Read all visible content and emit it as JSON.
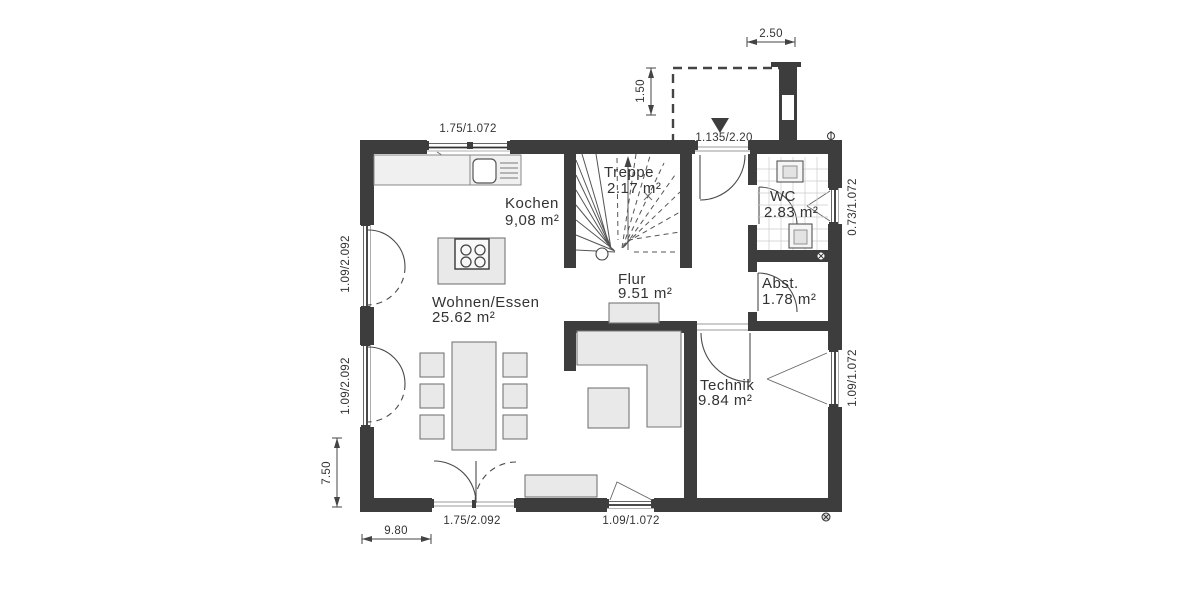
{
  "rooms": {
    "kochen": {
      "label": "Kochen",
      "area": "9,08 m²"
    },
    "treppe": {
      "label": "Treppe",
      "area": "2.17 m²"
    },
    "wc": {
      "label": "WC",
      "area": "2.83 m²"
    },
    "abstellraum": {
      "label": "Abst.",
      "area": "1.78 m²"
    },
    "flur": {
      "label": "Flur",
      "area": "9.51 m²"
    },
    "wohnen_essen": {
      "label": "Wohnen/Essen",
      "area": "25.62 m²"
    },
    "technik": {
      "label": "Technik",
      "area": "9.84 m²"
    }
  },
  "dimensions": {
    "kitchen_window": "1.75/1.072",
    "entrance_door": "1.135/2.20",
    "porch_width": "2.50",
    "porch_depth": "1.50",
    "wc_window": "0.73/1.072",
    "technik_window": "1.09/1.072",
    "left_window_upper": "1.09/2.092",
    "left_window_lower": "1.09/2.092",
    "terrace_door": "1.75/2.092",
    "bottom_window": "1.09/1.072",
    "overall_width": "9.80",
    "overall_depth": "7.50"
  },
  "colors": {
    "wall": "#3d3d3d",
    "line": "#4a4a4a",
    "furniture_fill": "#e9e9e9",
    "background": "#ffffff"
  }
}
